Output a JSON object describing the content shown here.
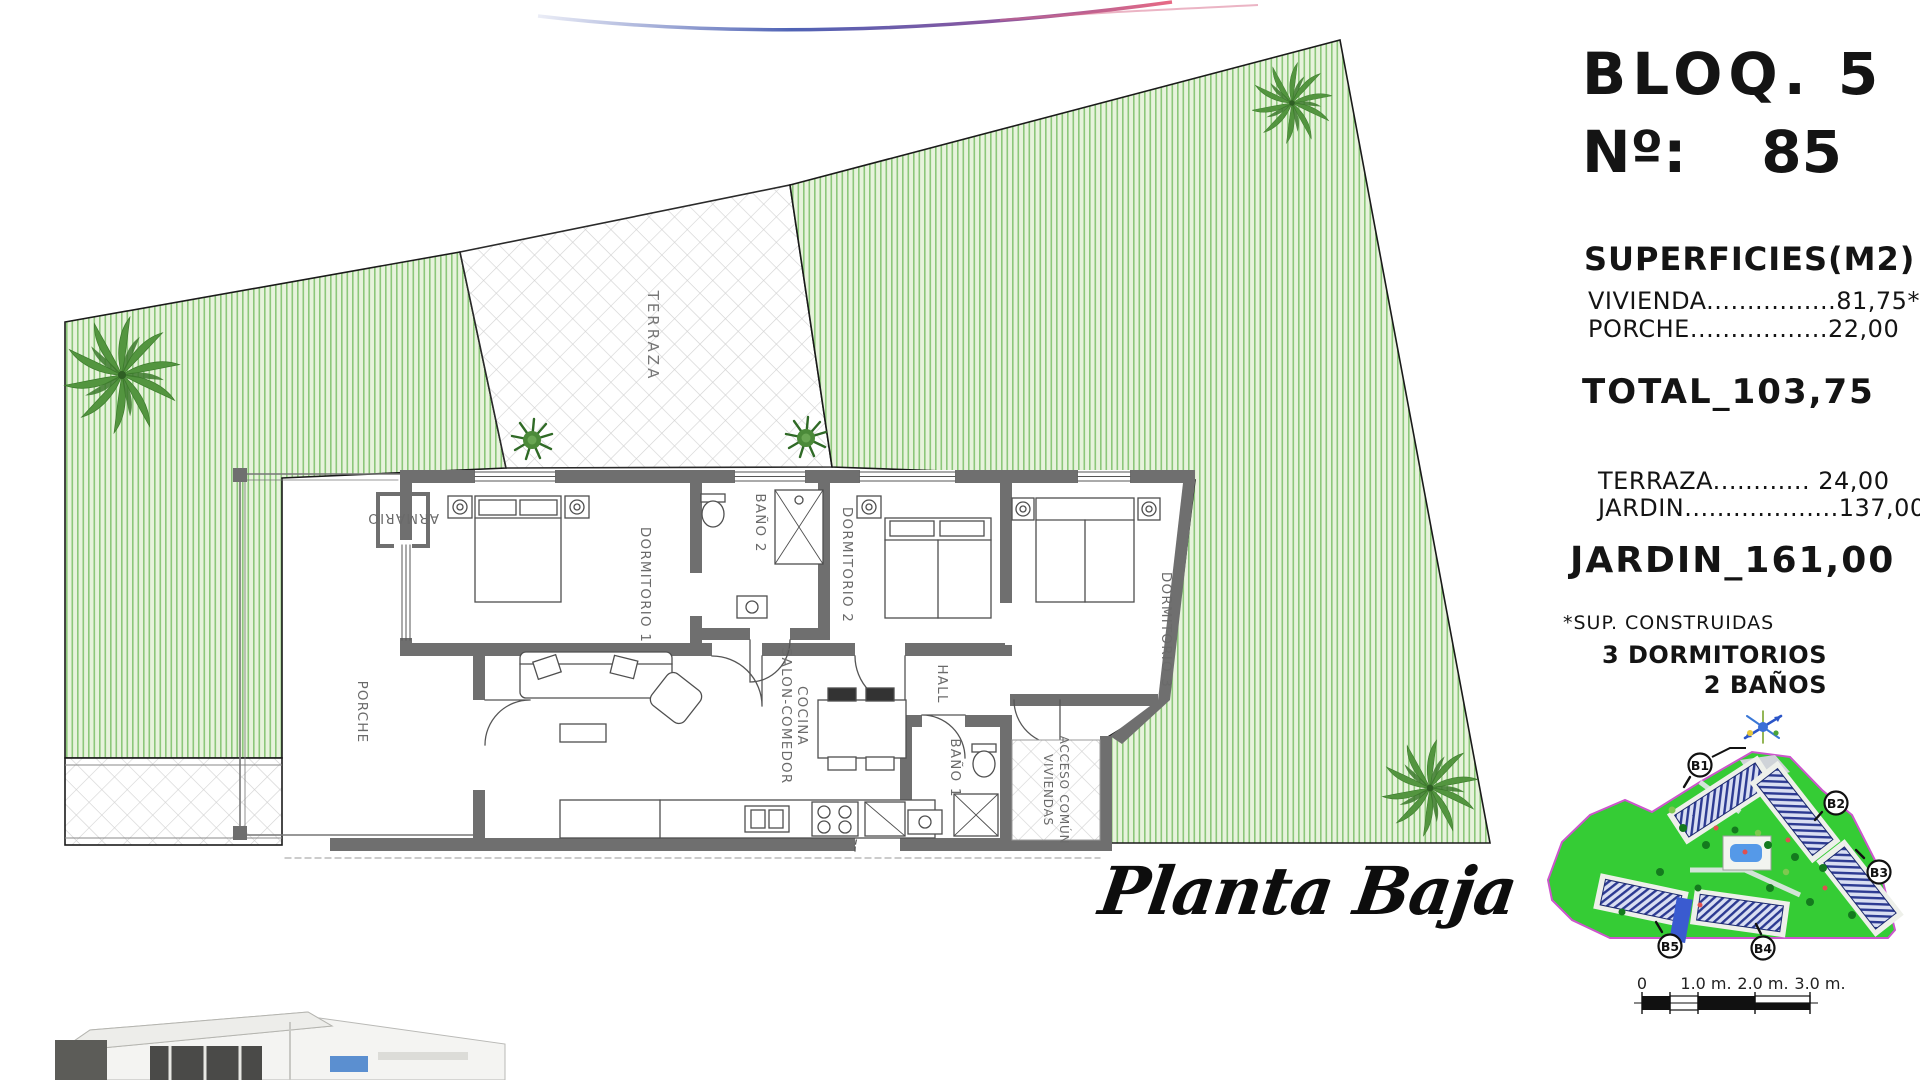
{
  "header": {
    "block": "BLOQ. 5",
    "unit_label": "Nº:",
    "unit_number": "85"
  },
  "areas": {
    "title": "SUPERFICIES(M2)",
    "built_rows": [
      {
        "label": "VIVIENDA",
        "dots": "................",
        "value": "81,75*"
      },
      {
        "label": "PORCHE",
        "dots": ".................",
        "value": "22,00"
      }
    ],
    "total": {
      "label": "TOTAL",
      "separator": "_",
      "value": "103,75"
    },
    "outdoor_rows": [
      {
        "label": "TERRAZA",
        "dots": "............",
        "value": "24,00"
      },
      {
        "label": "JARDIN",
        "dots": "...................",
        "value": "137,00"
      }
    ],
    "garden_total": {
      "label": "JARDIN",
      "separator": "_",
      "value": "161,00"
    },
    "footnote": "*SUP. CONSTRUIDAS",
    "bedrooms": "3 DORMITORIOS",
    "bathrooms": "2 BAÑOS"
  },
  "plan": {
    "caption": "Planta Baja",
    "rooms": {
      "terraza": "TERRAZA",
      "porche": "PORCHE",
      "armario": "ARMARIO",
      "dormitorio1": "DORMITORIO 1",
      "bano2": "BAÑO 2",
      "dormitorio2": "DORMITORIO 2",
      "dormitorio3": "DORMITORIO 3",
      "hall": "HALL",
      "salon_line1": "SALON-COMEDOR",
      "salon_line2": "COCINA",
      "bano1": "BAÑO 1",
      "acceso_line1": "ACCESO COMÚN",
      "acceso_line2": "VIVIENDAS"
    }
  },
  "site_plan": {
    "block_labels": [
      "B1",
      "B2",
      "B3",
      "B4",
      "B5"
    ]
  },
  "scale_bar": {
    "ticks": [
      "0",
      "1.0 m.",
      "2.0 m.",
      "3.0 m."
    ]
  },
  "colors": {
    "garden_stripe_green": "#8cc77a",
    "site_green": "#35cc35",
    "site_border_magenta": "#cc55cc",
    "wall_gray": "#6f6f6f",
    "swoosh_blue": "#4f63b5",
    "swoosh_pink": "#e86a84"
  }
}
